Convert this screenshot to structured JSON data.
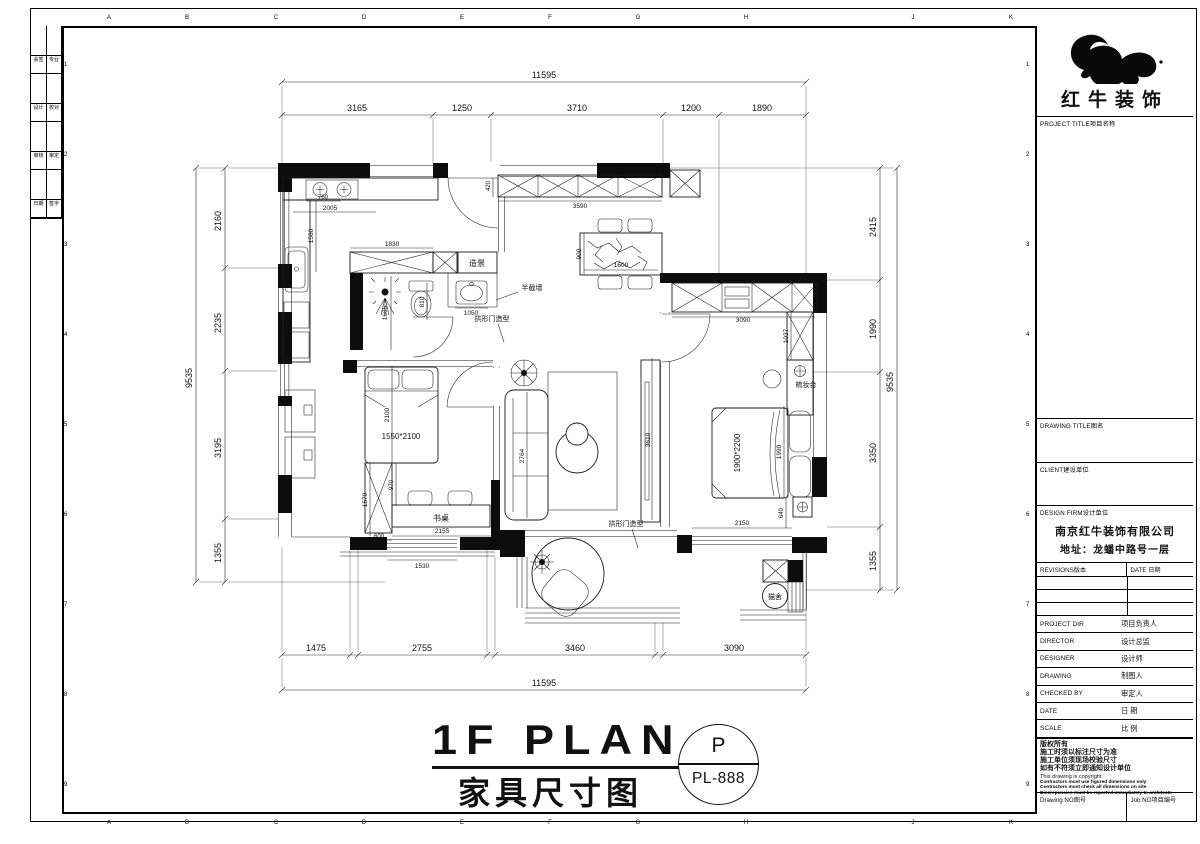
{
  "frame": {
    "grid_letters": [
      "A",
      "B",
      "C",
      "D",
      "E",
      "F",
      "G",
      "H",
      "J",
      "K"
    ],
    "grid_numbers": [
      "1",
      "2",
      "3",
      "4",
      "5",
      "6",
      "7",
      "8",
      "9"
    ],
    "approval_rows": [
      {
        "l": "会签",
        "r": "专业"
      },
      {
        "l": "设计",
        "r": "校对"
      },
      {
        "l": "审核",
        "r": "审定"
      },
      {
        "l": "日期",
        "r": "签字"
      }
    ]
  },
  "title_block": {
    "logo_text": "红牛装饰",
    "project_title_label": "PROJECT TITLE项目名称",
    "drawing_title_label": "DRAWING TITLE图名",
    "client_label": "CLIENT建设单位",
    "design_firm_label": "DESIGN FIRM设计单位",
    "firm_name": "南京红牛装饰有限公司",
    "firm_address": "地址：龙蟠中路号一层",
    "revisions_label": "REVISIONS版本",
    "date_col_label": "DATE 日期",
    "rows": [
      {
        "en": "PROJECT DIR",
        "cn": "项目负责人"
      },
      {
        "en": "DIRECTOR",
        "cn": "设计总监"
      },
      {
        "en": "DESIGNER",
        "cn": "设计师"
      },
      {
        "en": "DRAWING",
        "cn": "制图人"
      },
      {
        "en": "CHECKED BY",
        "cn": "审定人"
      },
      {
        "en": "DATE",
        "cn": "日 期"
      },
      {
        "en": "SCALE",
        "cn": "比 例"
      }
    ],
    "copyright_cn": [
      "版权所有",
      "施工时须以标注尺寸为准",
      "施工单位须现场校验尺寸",
      "如有不符须立即通知设计单位"
    ],
    "copyright_en_title": "This drawing is copyright",
    "copyright_en": [
      "Contractors must use figured dimensions only",
      "Contractors must check all dimensions on site",
      "Discrepancies must be reported immediately to architects"
    ],
    "drawing_no_label": "Drawing NO图号",
    "job_no_label": "Job NO项目编号"
  },
  "plan": {
    "labels": {
      "scenery": "造景",
      "half_wall": "半截墙",
      "arch_door_1": "拱形门造型",
      "arch_door_2": "拱形门造型",
      "desk": "书桌",
      "dresser": "梳妆台",
      "cat_house": "猫舍",
      "bed_small": "1550*2100",
      "bed_large": "1900*2200"
    },
    "dims": {
      "top_overall": "11595",
      "top": [
        "3165",
        "1250",
        "3710",
        "1200",
        "1890"
      ],
      "bottom": [
        "1475",
        "2755",
        "3460",
        "3090"
      ],
      "bottom_overall": "11595",
      "left_overall": "9535",
      "left": [
        "2160",
        "2235",
        "3195",
        "1355"
      ],
      "right_overall": "9535",
      "right": [
        "2415",
        "1990",
        "3350",
        "1355"
      ],
      "kitchen": {
        "counter": "2005",
        "stove": "760",
        "side": "1560"
      },
      "bath": {
        "cabinet": "1830",
        "shower": "1665",
        "toilet": "810",
        "basin": "1050"
      },
      "hall": {
        "closet": "3590",
        "closet_depth": "420"
      },
      "dining": {
        "w": "900",
        "l": "1600"
      },
      "master": {
        "wardrobe": "3090",
        "side": "1037",
        "bed": "1990",
        "walk": "2150",
        "night": "640"
      },
      "bed2": {
        "len": "2100",
        "wardrobe": "1570",
        "wardrobe_w": "600",
        "gap": "970",
        "desk": "2155",
        "window": "1530"
      },
      "living": {
        "sofa": "2764",
        "tv_wall": "3610"
      }
    }
  },
  "footer": {
    "title_en": "1F PLAN",
    "title_cn": "家具尺寸图",
    "stamp_top": "P",
    "stamp_bottom": "PL-888"
  }
}
